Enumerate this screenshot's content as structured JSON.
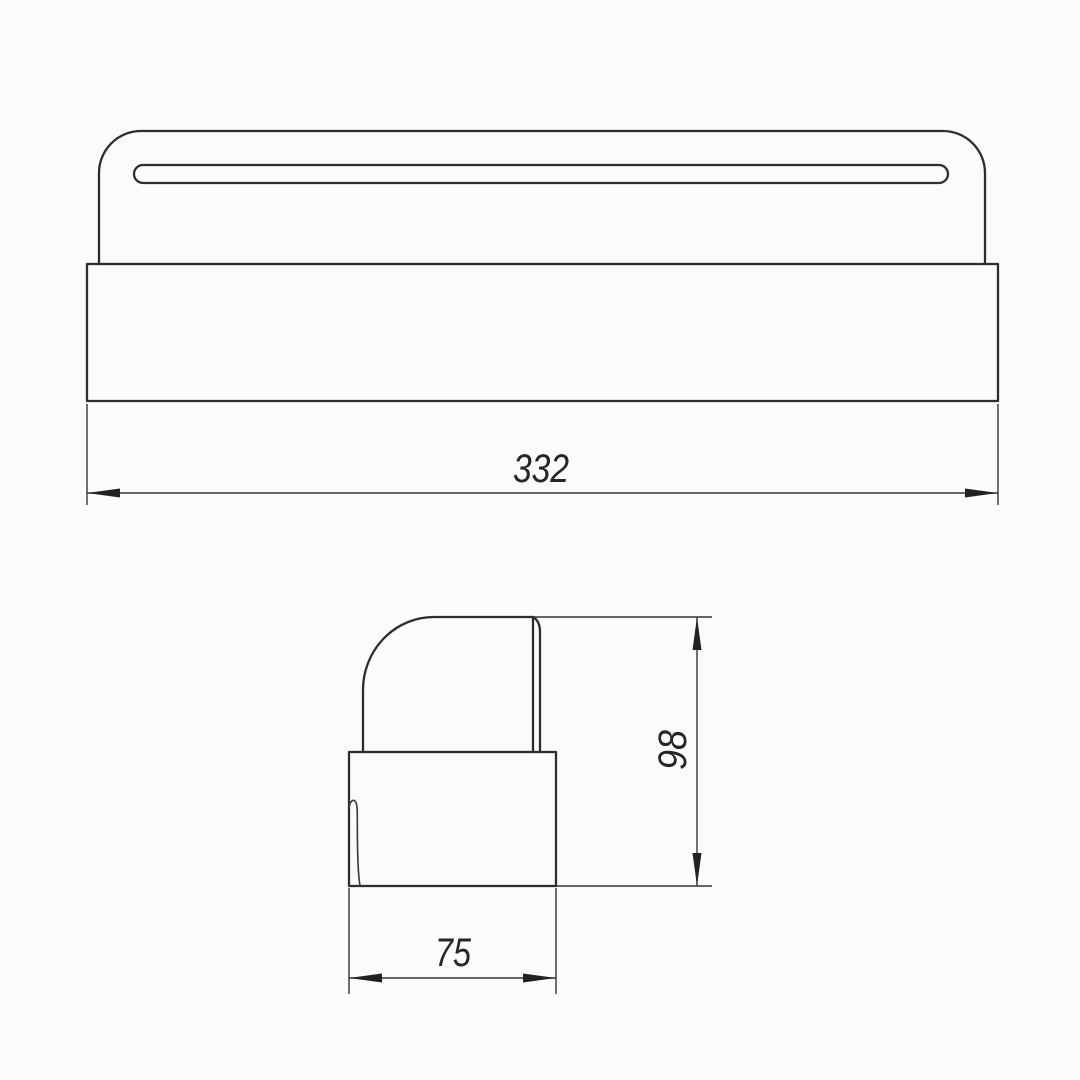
{
  "drawing": {
    "kind": "engineering-drawing-two-views",
    "colors": {
      "background": "#fbfbfb",
      "line": "#2d2d2d",
      "dimension_line": "#353535",
      "text": "#262626"
    },
    "dimensions": {
      "front_width": "332",
      "side_height": "98",
      "side_depth": "75"
    }
  }
}
